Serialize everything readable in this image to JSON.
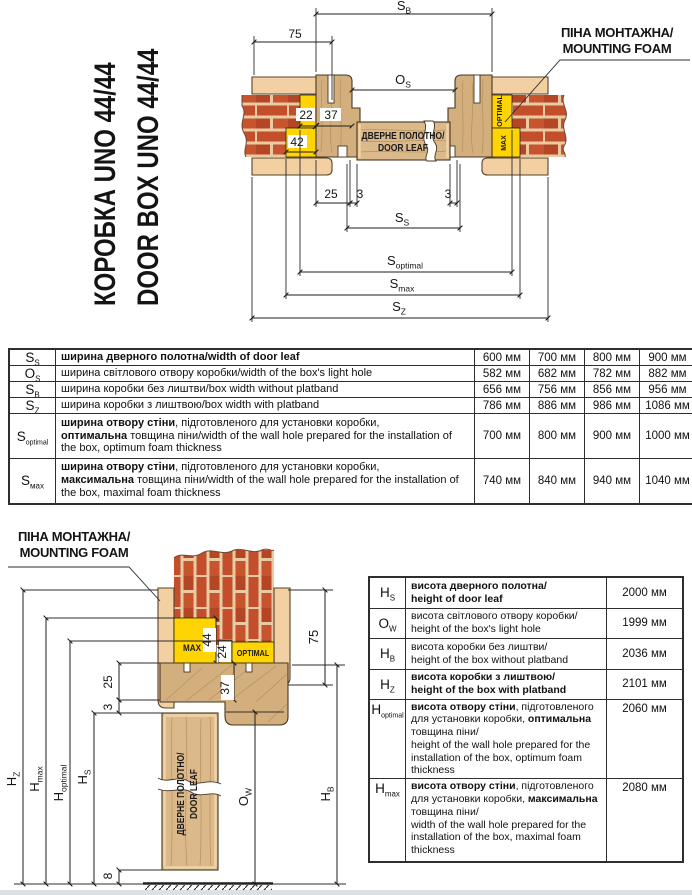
{
  "title": {
    "line1": "КОРОБКА UNO 44/44",
    "line2": "DOOR BOX UNO 44/44"
  },
  "foam_top": {
    "line1": "ПІНА МОНТАЖНА/",
    "line2": "MOUNTING FOAM"
  },
  "foam_bottom": {
    "line1": "ПІНА МОНТАЖНА/",
    "line2": "MOUNTING FOAM"
  },
  "top": {
    "leaf1": "ДВЕРНЕ ПОЛОТНО/",
    "leaf2": "DOOR LEAF",
    "optimal": "OPTIMAL",
    "max": "MAX",
    "sb_m": "S",
    "sb_s": "B",
    "os_m": "O",
    "os_s": "S",
    "ss_m": "S",
    "ss_s": "S",
    "sopt_m": "S",
    "sopt_s": "optimal",
    "smax_m": "S",
    "smax_s": "max",
    "sz_m": "S",
    "sz_s": "Z",
    "d75": "75",
    "d22": "22",
    "d37": "37",
    "d42": "42",
    "d25": "25",
    "d3l": "3",
    "d3r": "3"
  },
  "bottom": {
    "leaf1": "ДВЕРНЕ ПОЛОТНО/",
    "leaf2": "DOOR LEAF",
    "optimal": "OPTIMAL",
    "max": "MAX",
    "hz_m": "H",
    "hz_s": "Z",
    "hmax_m": "H",
    "hmax_s": "max",
    "hopt_m": "H",
    "hopt_s": "optimal",
    "hs_m": "H",
    "hs_s": "S",
    "ow_m": "O",
    "ow_s": "W",
    "hb_m": "H",
    "hb_s": "B",
    "d75": "75",
    "d44": "44",
    "d24": "24",
    "d37": "37",
    "d25": "25",
    "d3": "3",
    "d8": "8"
  },
  "t1": {
    "rows": [
      {
        "sym": "S",
        "sub": "S",
        "desc": [
          "ширина дверного полотна/width of door leaf",
          "",
          "",
          ""
        ],
        "values": [
          "600 мм",
          "700 мм",
          "800 мм",
          "900 мм"
        ]
      },
      {
        "sym": "O",
        "sub": "S",
        "desc": [
          "",
          "ширина світлового отвору коробки/width of the box's light hole",
          "",
          ""
        ],
        "values": [
          "582 мм",
          "682 мм",
          "782 мм",
          "882 мм"
        ]
      },
      {
        "sym": "S",
        "sub": "B",
        "desc": [
          "",
          "ширина коробки без лиштви/box width without platband",
          "",
          ""
        ],
        "values": [
          "656 мм",
          "756 мм",
          "856 мм",
          "956 мм"
        ]
      },
      {
        "sym": "S",
        "sub": "Z",
        "desc": [
          "",
          "ширина коробки з лиштвою/box width with platband",
          "",
          ""
        ],
        "values": [
          "786 мм",
          "886 мм",
          "986 мм",
          "1086 мм"
        ]
      },
      {
        "sym": "S",
        "sub": "optimal",
        "desc": [
          "ширина отвору стіни",
          ", підготовленого для установки коробки,\n",
          "оптимальна",
          " товщина піни/width of the wall hole prepared for the installation of the box, optimum foam thickness"
        ],
        "values": [
          "700 мм",
          "800 мм",
          "900 мм",
          "1000 мм"
        ]
      },
      {
        "sym": "S",
        "sub": "мах",
        "desc": [
          "ширина отвору стіни",
          ", підготовленого для установки коробки,\n",
          "максимальна",
          " товщина піни/width of the wall hole prepared for the installation of the box, maximal foam thickness"
        ],
        "values": [
          "740 мм",
          "840 мм",
          "940 мм",
          "1040 мм"
        ]
      }
    ]
  },
  "t2": {
    "rows": [
      {
        "sym": "H",
        "sub": "S",
        "desc": [
          "висота дверного полотна/\nheight of door leaf",
          "",
          "",
          ""
        ],
        "value": "2000 мм"
      },
      {
        "sym": "O",
        "sub": "W",
        "desc": [
          "",
          "висота світлового отвору коробки/\nheight of the box's light hole",
          "",
          ""
        ],
        "value": "1999 мм"
      },
      {
        "sym": "H",
        "sub": "B",
        "desc": [
          "",
          "висота коробки без лиштви/\nheight of the box without platband",
          "",
          ""
        ],
        "value": "2036 мм"
      },
      {
        "sym": "H",
        "sub": "Z",
        "desc": [
          "висота коробки з лиштвою/\nheight of the box with platband",
          "",
          "",
          ""
        ],
        "value": "2101 мм"
      },
      {
        "sym": "H",
        "sub": "optimal",
        "desc": [
          "висота отвору стіни",
          ", підготовленого для установки коробки, ",
          "оптимальна",
          " товщина піни/\nheight of the wall hole prepared for the installation of the box, optimum foam thickness"
        ],
        "value": "2060 мм"
      },
      {
        "sym": "H",
        "sub": "max",
        "desc": [
          "висота отвору стіни",
          ", підготовленого для установки коробки, ",
          "максимальна",
          " товщина піни/\nwidth of the wall hole prepared for the installation of the box, maximal foam thickness"
        ],
        "value": "2080 мм"
      }
    ]
  },
  "colors": {
    "foam": "#ffd400",
    "brick": "#c24e2c",
    "mortar": "#e8caa3",
    "platband": "#f3d0a2",
    "wood": "#d4af7e",
    "line": "#1a1a1a"
  }
}
